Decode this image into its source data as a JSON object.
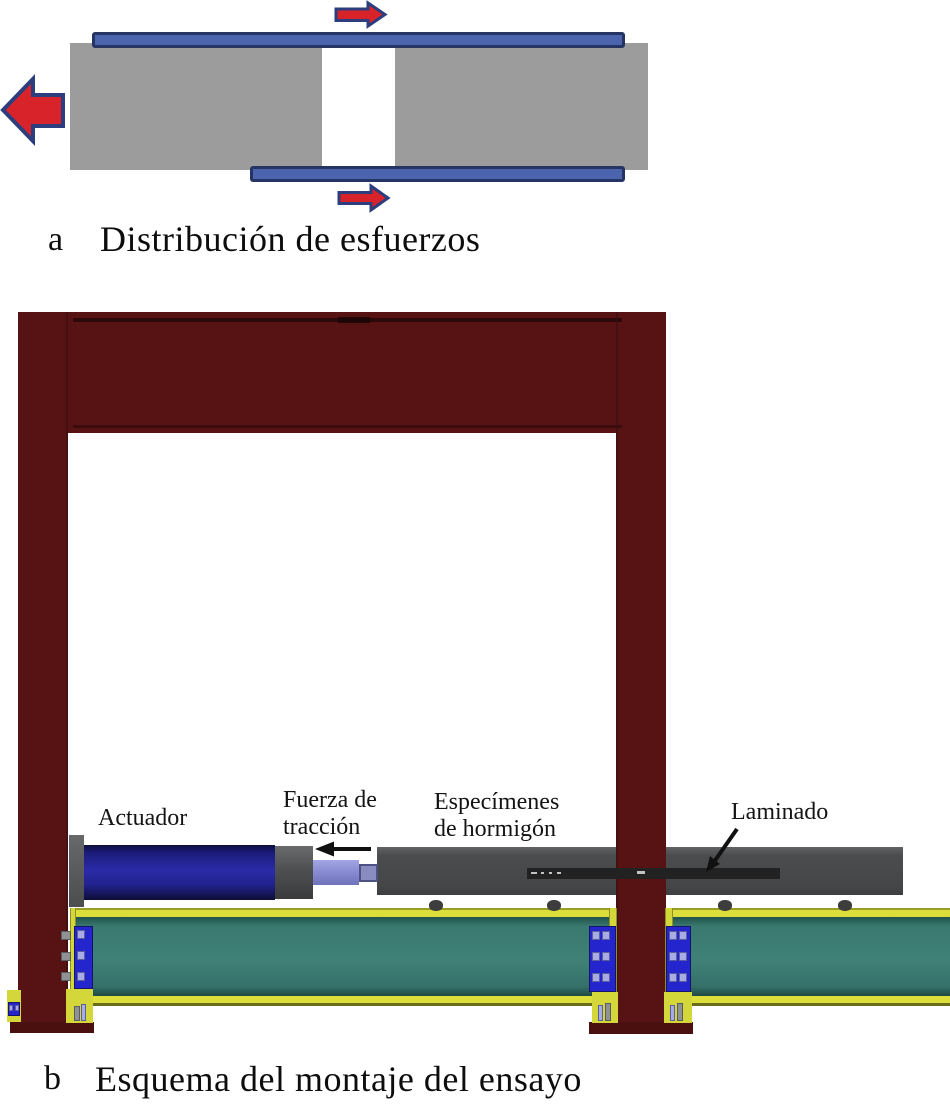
{
  "figure": {
    "panel_a": {
      "label": "a",
      "caption": "Distribución de esfuerzos"
    },
    "panel_b": {
      "label": "b",
      "caption": "Esquema del montaje del ensayo",
      "labels": {
        "actuator": "Actuador",
        "traction_force_line1": "Fuerza de",
        "traction_force_line2": "tracción",
        "specimens_line1": "Especímenes",
        "specimens_line2": "de hormigón",
        "laminate": "Laminado"
      }
    },
    "colors": {
      "frame_maroon": "#571313",
      "concrete_gray": "#9c9c9c",
      "frp_strip_blue": "#4c64ae",
      "force_arrow_red": "#d8232a",
      "arrow_outline_navy": "#2c3e7d",
      "actuator_blue": "#22229b",
      "piston_lavender": "#9194d9",
      "specimen_gray": "#4a4c4e",
      "laminate_black": "#222222",
      "base_beam_teal": "#3a7a70",
      "plate_yellow": "#dcdf3b",
      "bolt_plate_blue": "#2525ce",
      "annotation_black": "#111111"
    }
  }
}
